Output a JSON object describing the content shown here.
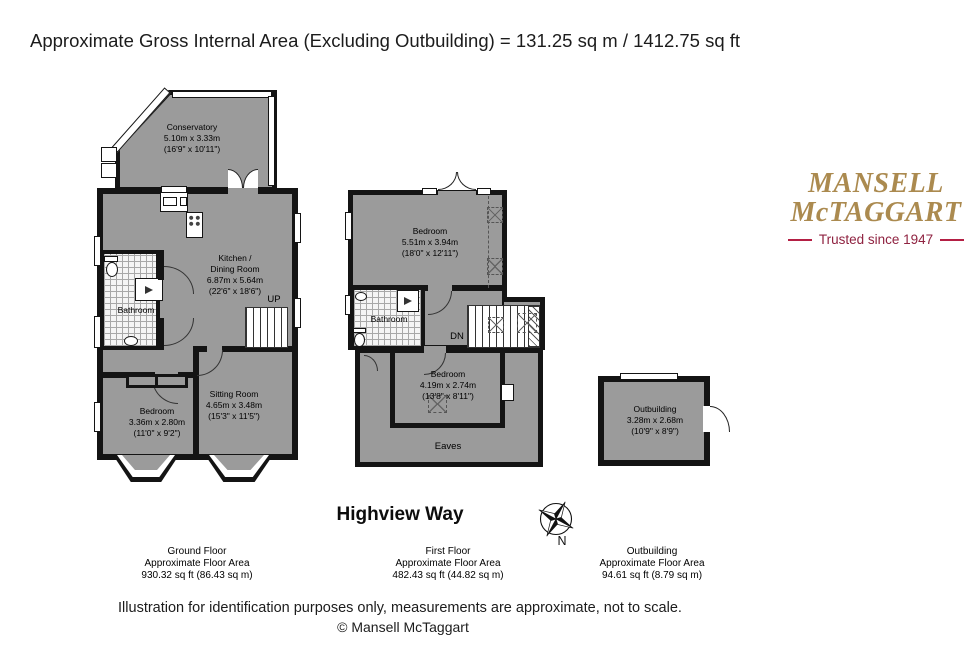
{
  "header": {
    "title": "Approximate Gross Internal Area (Excluding Outbuilding) = 131.25 sq m / 1412.75 sq ft"
  },
  "logo": {
    "name_line1": "MANSELL",
    "name_line2": "McTAGGART",
    "tagline": "Trusted since 1947"
  },
  "property": {
    "name": "Highview Way"
  },
  "compass": {
    "north_label": "N"
  },
  "floors": {
    "ground": {
      "label": "Ground Floor",
      "area_label": "Approximate Floor Area",
      "area_value": "930.32 sq ft (86.43 sq m)",
      "rooms": {
        "conservatory": {
          "name": "Conservatory",
          "dims_m": "5.10m x 3.33m",
          "dims_ft": "(16'9\" x 10'11\")"
        },
        "kitchen_dining": {
          "name_line1": "Kitchen /",
          "name_line2": "Dining Room",
          "dims_m": "6.87m x 5.64m",
          "dims_ft": "(22'6\" x 18'6\")"
        },
        "bathroom": {
          "name": "Bathroom"
        },
        "sitting_room": {
          "name": "Sitting Room",
          "dims_m": "4.65m x 3.48m",
          "dims_ft": "(15'3\" x 11'5\")"
        },
        "bedroom": {
          "name": "Bedroom",
          "dims_m": "3.36m x 2.80m",
          "dims_ft": "(11'0\" x 9'2\")"
        },
        "stairs_label": "UP"
      }
    },
    "first": {
      "label": "First Floor",
      "area_label": "Approximate Floor Area",
      "area_value": "482.43 sq ft (44.82 sq m)",
      "rooms": {
        "bedroom_main": {
          "name": "Bedroom",
          "dims_m": "5.51m x 3.94m",
          "dims_ft": "(18'0\" x 12'11\")"
        },
        "bathroom": {
          "name": "Bathroom"
        },
        "bedroom_rear": {
          "name": "Bedroom",
          "dims_m": "4.19m x 2.74m",
          "dims_ft": "(13'8\" x 8'11\")"
        },
        "eaves": {
          "name": "Eaves"
        },
        "stairs_label": "DN"
      }
    },
    "outbuilding": {
      "label": "Outbuilding",
      "area_label": "Approximate Floor Area",
      "area_value": "94.61 sq ft (8.79 sq m)",
      "rooms": {
        "outbuilding": {
          "name": "Outbuilding",
          "dims_m": "3.28m x 2.68m",
          "dims_ft": "(10'9\" x 8'9\")"
        }
      }
    }
  },
  "footer": {
    "disclaimer": "Illustration for identification purposes only, measurements are approximate, not to scale.",
    "copyright": "© Mansell McTaggart"
  },
  "colors": {
    "wall": "#141414",
    "room_fill": "#9b9b9b",
    "logo_gold": "#ab8a4f",
    "logo_red": "#8f2240",
    "line_red": "#b41f44"
  }
}
